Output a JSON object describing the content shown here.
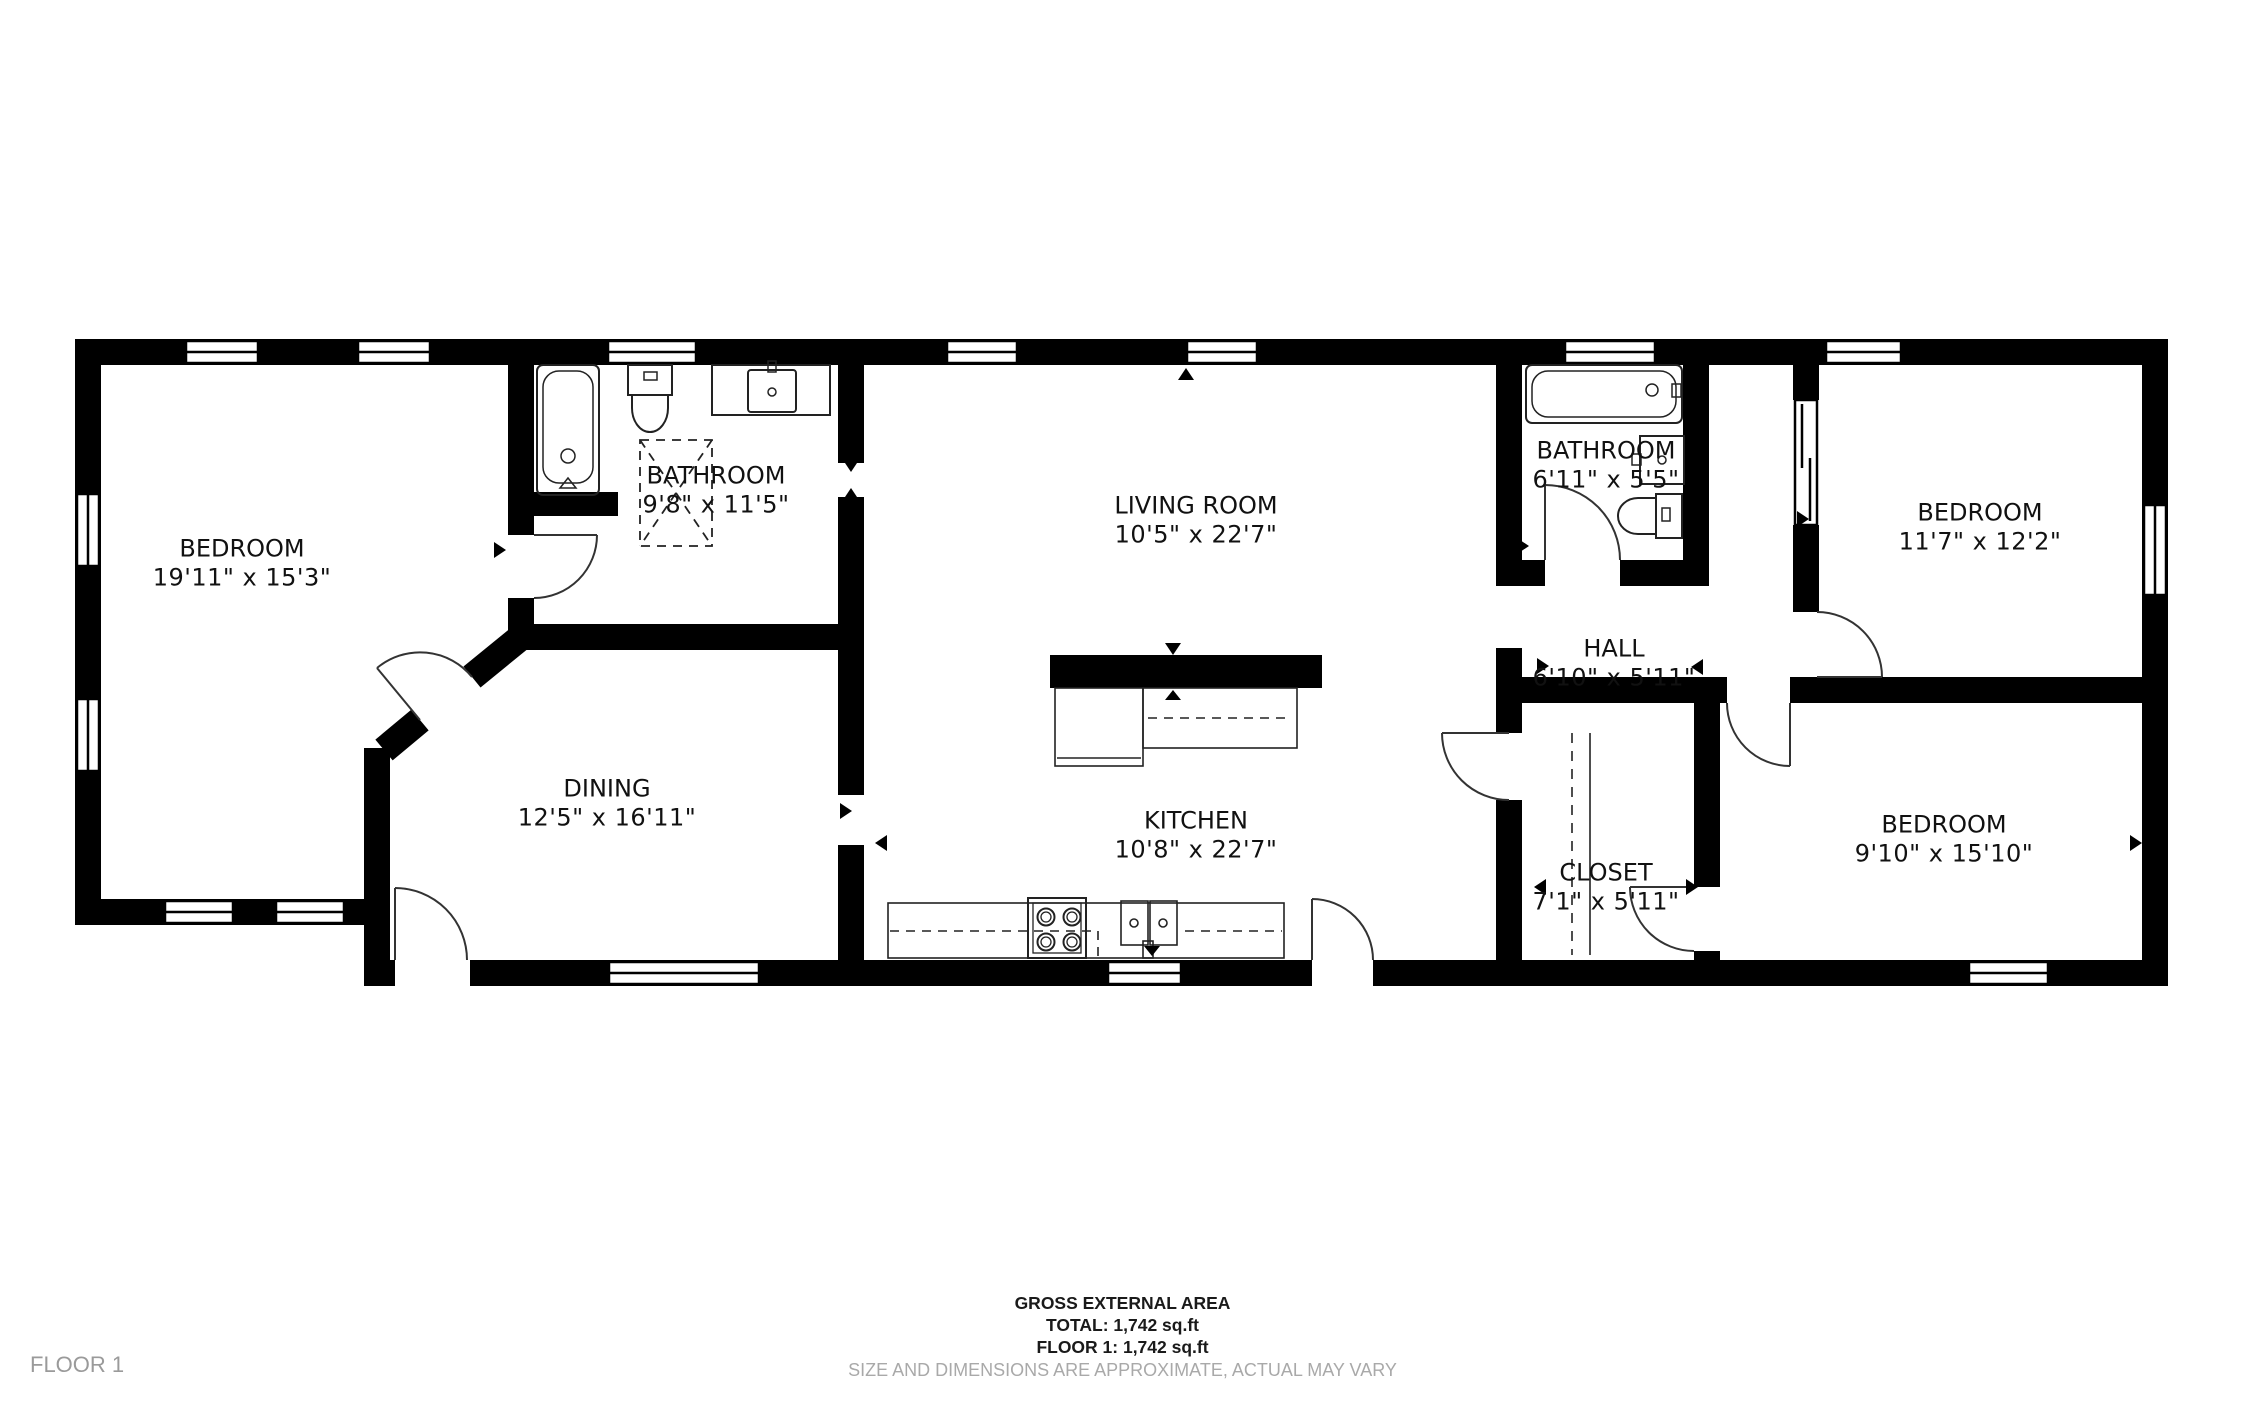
{
  "floor_label": "FLOOR 1",
  "footer": {
    "line1": "GROSS EXTERNAL AREA",
    "line2": "TOTAL: 1,742 sq.ft",
    "line3": "FLOOR 1: 1,742 sq.ft",
    "disclaimer": "SIZE AND DIMENSIONS ARE APPROXIMATE, ACTUAL MAY VARY"
  },
  "rooms": [
    {
      "name": "BEDROOM",
      "dims": "19'11\" x 15'3\""
    },
    {
      "name": "BATHROOM",
      "dims": "9'8\" x 11'5\""
    },
    {
      "name": "DINING",
      "dims": "12'5\" x 16'11\""
    },
    {
      "name": "LIVING ROOM",
      "dims": "10'5\" x 22'7\""
    },
    {
      "name": "KITCHEN",
      "dims": "10'8\" x 22'7\""
    },
    {
      "name": "BATHROOM",
      "dims": "6'11\" x 5'5\""
    },
    {
      "name": "HALL",
      "dims": "6'10\" x 5'11\""
    },
    {
      "name": "CLOSET",
      "dims": "7'1\" x 5'11\""
    },
    {
      "name": "BEDROOM",
      "dims": "11'7\" x 12'2\""
    },
    {
      "name": "BEDROOM",
      "dims": "9'10\" x 15'10\""
    }
  ],
  "colors": {
    "wall": "#000000",
    "background": "#ffffff",
    "muted_text": "#9a9a9a"
  }
}
